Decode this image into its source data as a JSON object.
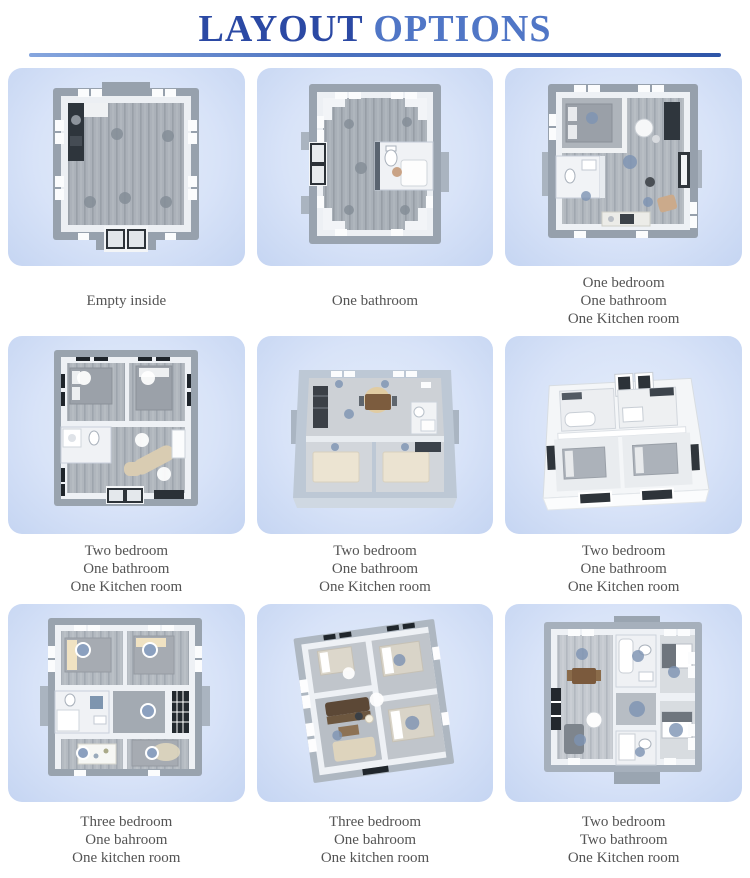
{
  "header": {
    "title_part1": "LAYOUT",
    "title_part2": " OPTIONS",
    "title_full": "LAYOUT OPTIONS"
  },
  "colors": {
    "title_dark_blue": "#2b49a4",
    "title_light_blue": "#5076c6",
    "underline_blue": "#3a62b5",
    "card_background": "#d7e3f8",
    "caption_text": "#545454"
  },
  "cells": [
    {
      "plan": "empty-room-floorplan",
      "caption": [
        "Empty inside"
      ]
    },
    {
      "plan": "one-bathroom-floorplan",
      "caption": [
        "One bathroom"
      ]
    },
    {
      "plan": "one-bedroom-one-bathroom-one-kitchen-floorplan",
      "caption": [
        "One bedroom",
        "One bathroom",
        "One Kitchen room"
      ]
    },
    {
      "plan": "two-bedroom-floorplan-top-view",
      "caption": [
        "Two bedroom",
        "One bathroom",
        "One Kitchen room"
      ]
    },
    {
      "plan": "two-bedroom-floorplan-3d-view",
      "caption": [
        "Two bedroom",
        "One bathroom",
        "One Kitchen room"
      ]
    },
    {
      "plan": "two-bedroom-floorplan-isometric",
      "caption": [
        "Two bedroom",
        "One bathroom",
        "One Kitchen room"
      ]
    },
    {
      "plan": "three-bedroom-floorplan-top-view",
      "caption": [
        "Three bedroom",
        "One bahroom",
        "One kitchen room"
      ]
    },
    {
      "plan": "three-bedroom-floorplan-rotated",
      "caption": [
        "Three bedroom",
        "One bahroom",
        "One kitchen room"
      ]
    },
    {
      "plan": "two-bedroom-two-bathroom-floorplan",
      "caption": [
        "Two bedroom",
        "Two bathroom",
        "One Kitchen room"
      ]
    }
  ]
}
